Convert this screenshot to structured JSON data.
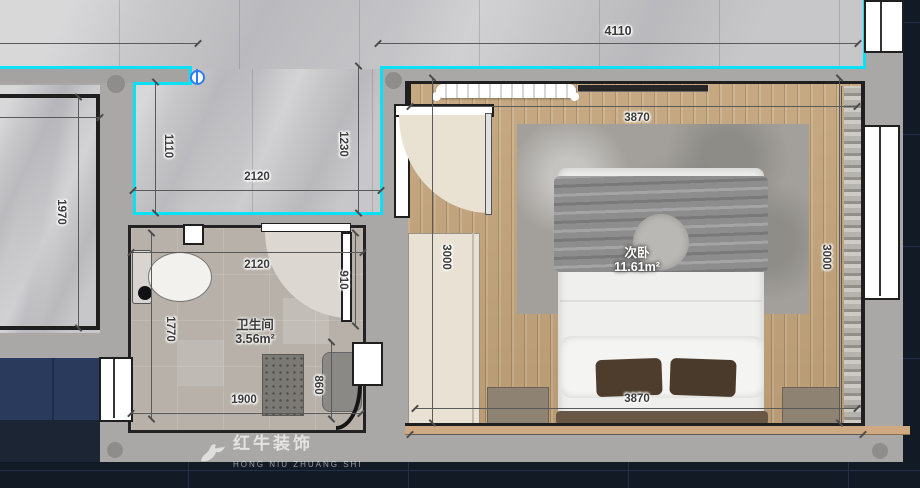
{
  "watermark": {
    "brand": "红牛装饰",
    "subtext": "HONG NIU ZHUANG SHI"
  },
  "rooms": {
    "bedroom": {
      "name": "次卧",
      "area": "11.61m²"
    },
    "bathroom": {
      "name": "卫生间",
      "area": "3.56m²"
    }
  },
  "dimensions": {
    "top_overall": "4110",
    "bedroom_top_inner": "3870",
    "bedroom_bottom_inner": "3870",
    "bedroom_left": "3000",
    "bedroom_right": "3000",
    "hallway_left": "1110",
    "hallway_right": "1230",
    "hallway_width": "2120",
    "bathroom_top": "2120",
    "bathroom_door": "910",
    "bathroom_left": "1770",
    "bathroom_bottom": "1900",
    "shower": "860",
    "left_room_height": "1970"
  },
  "colors": {
    "wall_highlight_cyan": "#0ae1f6",
    "plumbing_marker_blue": "#2f7df6",
    "wood_floor": "#c2a37a",
    "marble_floor": "#c7c7c9"
  }
}
